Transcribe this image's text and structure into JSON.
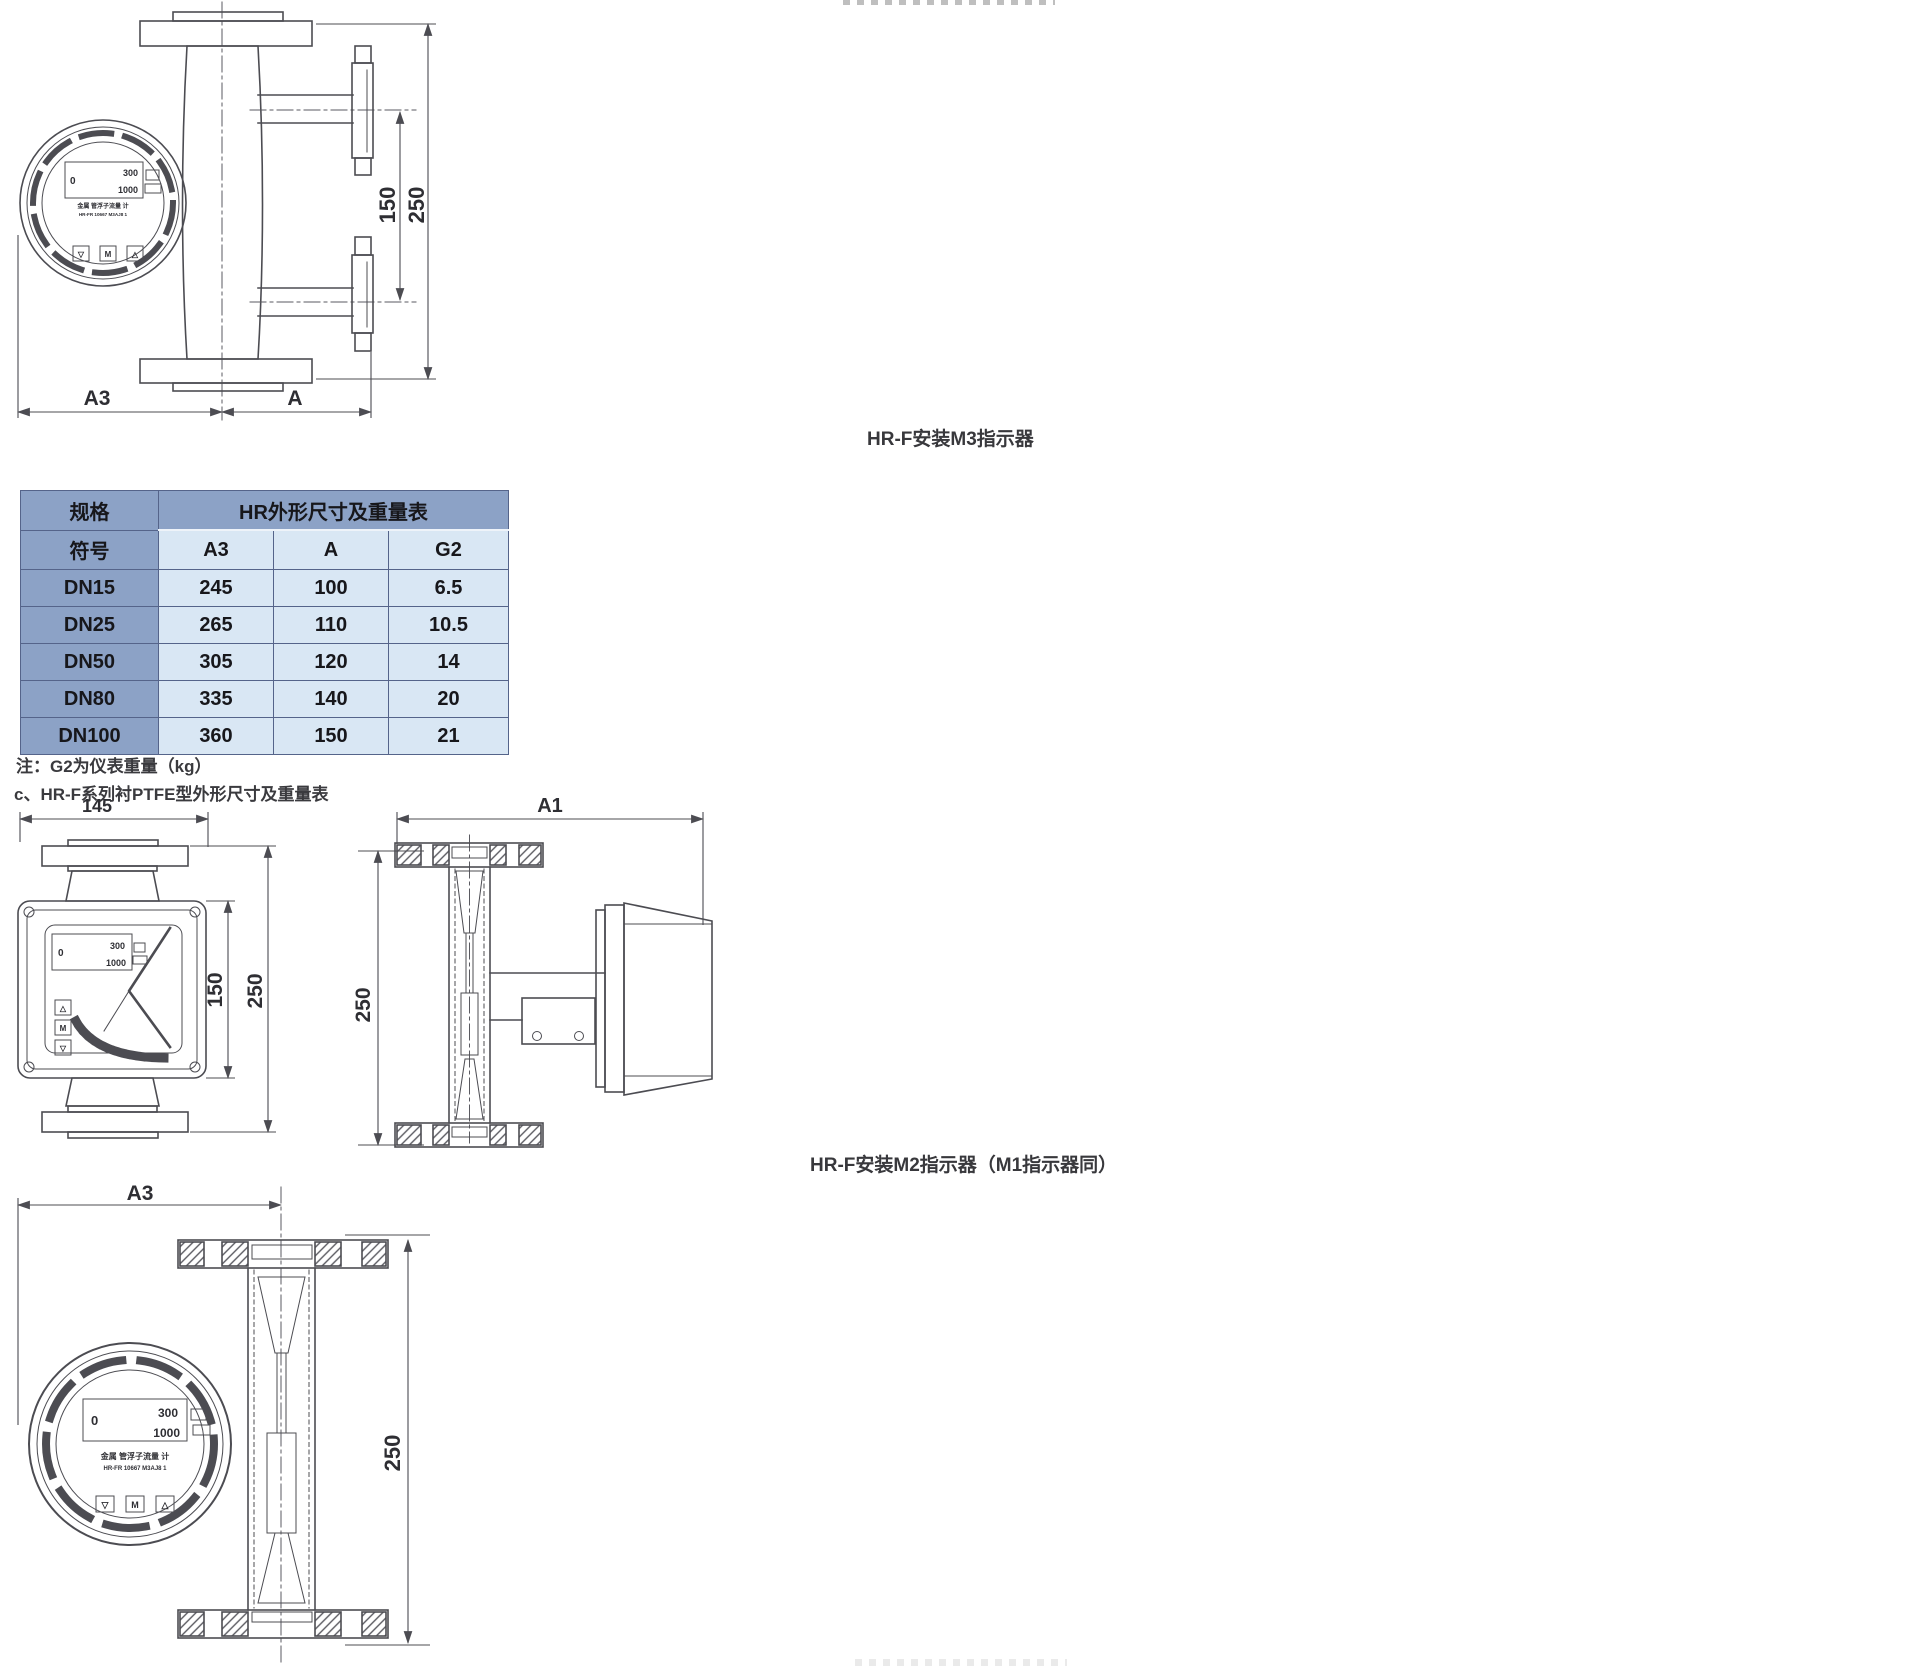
{
  "page": {
    "bg": "#ffffff",
    "ink": "#4c4c52"
  },
  "captions": {
    "m3": "HR-F安装M3指示器",
    "m2": "HR-F安装M2指示器（M1指示器同）"
  },
  "notes": {
    "g2_note": "注：G2为仪表重量（kg）",
    "section_c": "c、HR-F系列衬PTFE型外形尺寸及重量表"
  },
  "table": {
    "corner_top": "规格",
    "corner_bottom": "符号",
    "title": "HR外形尺寸及重量表",
    "columns": [
      "A3",
      "A",
      "G2"
    ],
    "rows": [
      [
        "DN15",
        "245",
        "100",
        "6.5"
      ],
      [
        "DN25",
        "265",
        "110",
        "10.5"
      ],
      [
        "DN50",
        "305",
        "120",
        "14"
      ],
      [
        "DN80",
        "335",
        "140",
        "20"
      ],
      [
        "DN100",
        "360",
        "150",
        "21"
      ]
    ],
    "header_bg": "#8ca2c6",
    "cell_bg": "#d9e7f4",
    "border_color": "#55648a"
  },
  "dims": {
    "d150": "150",
    "d250": "250",
    "d145": "145",
    "a3": "A3",
    "a": "A",
    "a1": "A1"
  },
  "gauge": {
    "zero": "0",
    "range_top": "300",
    "range_bottom": "1000",
    "label_line1": "金属 管浮子流量 计",
    "label_line2": "HR-FR 10667 M3AJ8 1",
    "btn_down": "▽",
    "btn_mode": "M",
    "btn_up": "△"
  }
}
